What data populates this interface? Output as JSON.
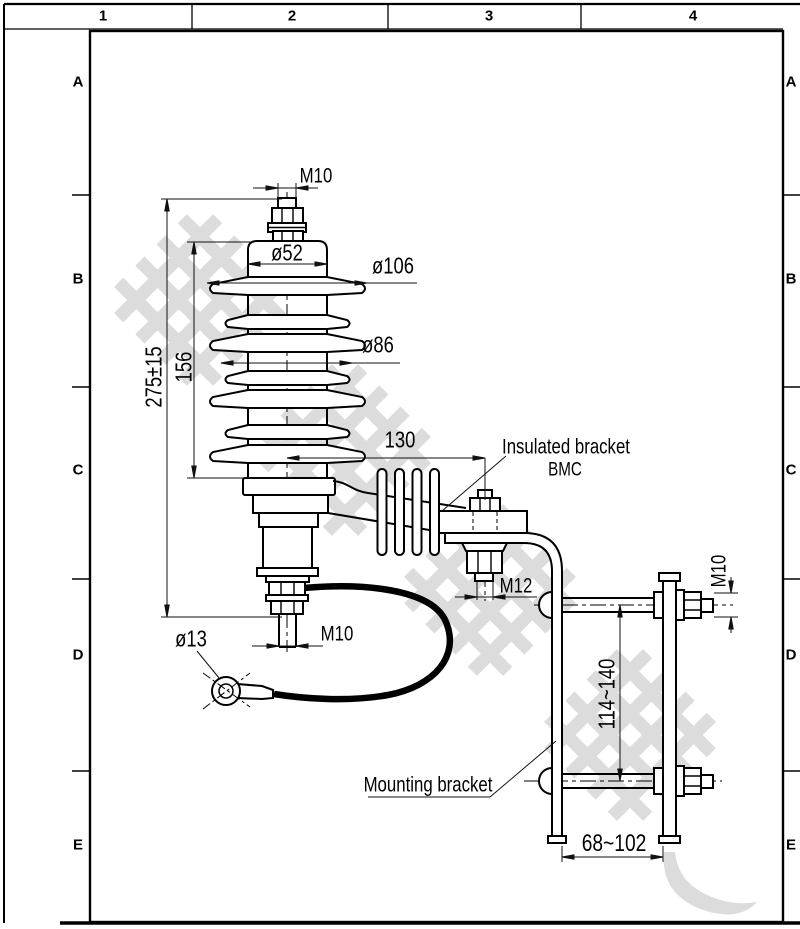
{
  "sheet": {
    "zone_cols": [
      "1",
      "2",
      "3",
      "4"
    ],
    "zone_rows": [
      "A",
      "B",
      "C",
      "D",
      "E"
    ]
  },
  "annotations": {
    "top_stud_thread": "M10",
    "cap_diameter": "ø52",
    "large_shed_diameter": "ø106",
    "small_shed_diameter": "ø86",
    "overall_height": "275±15",
    "housing_height": "156",
    "bracket_offset": "130",
    "bracket_bolt_thread": "M12",
    "bottom_stud_thread": "M10",
    "lug_hole_diameter": "ø13",
    "clamp_bolt_thread": "M10",
    "bolt_spacing_range": "114~140",
    "clamp_opening_range": "68~102"
  },
  "labels": {
    "insulated_bracket": "Insulated bracket",
    "insulated_bracket_material": "BMC",
    "mounting_bracket": "Mounting bracket"
  },
  "watermark": {
    "legible": false,
    "description": "large light-gray diagonal lattice characters with curved swoosh",
    "color": "#dcdcdc"
  },
  "colors": {
    "background": "#ffffff",
    "line": "#000000",
    "dimension": "#111111",
    "watermark": "#dcdcdc"
  }
}
